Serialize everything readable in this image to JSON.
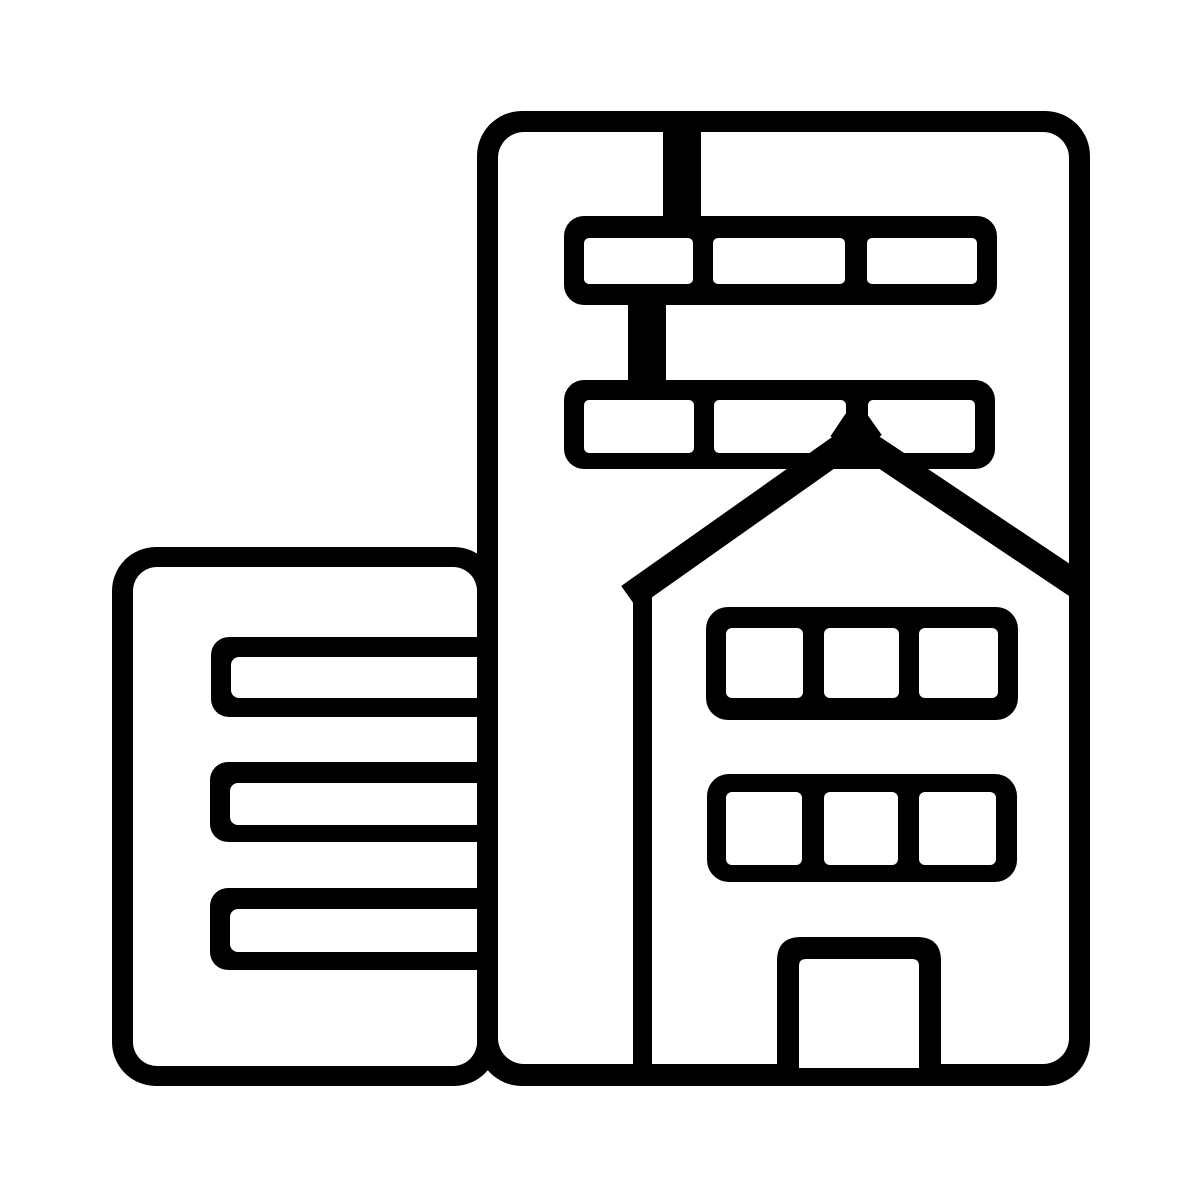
{
  "icon": {
    "label": "Buildings pictogram: tall office tower with window strips, house-shaped annex with door, and small side building with three window slots",
    "name": "buildings-icon",
    "style": "black line-art glyph on white background"
  },
  "colors": {
    "ink": "#000000",
    "background": "#ffffff"
  },
  "structure": {
    "tower_window_rows": 2,
    "tower_windows_per_row": 3,
    "annex_window_rows": 2,
    "annex_windows_per_row": 3,
    "side_building_window_bars": 3,
    "doors": 1
  }
}
